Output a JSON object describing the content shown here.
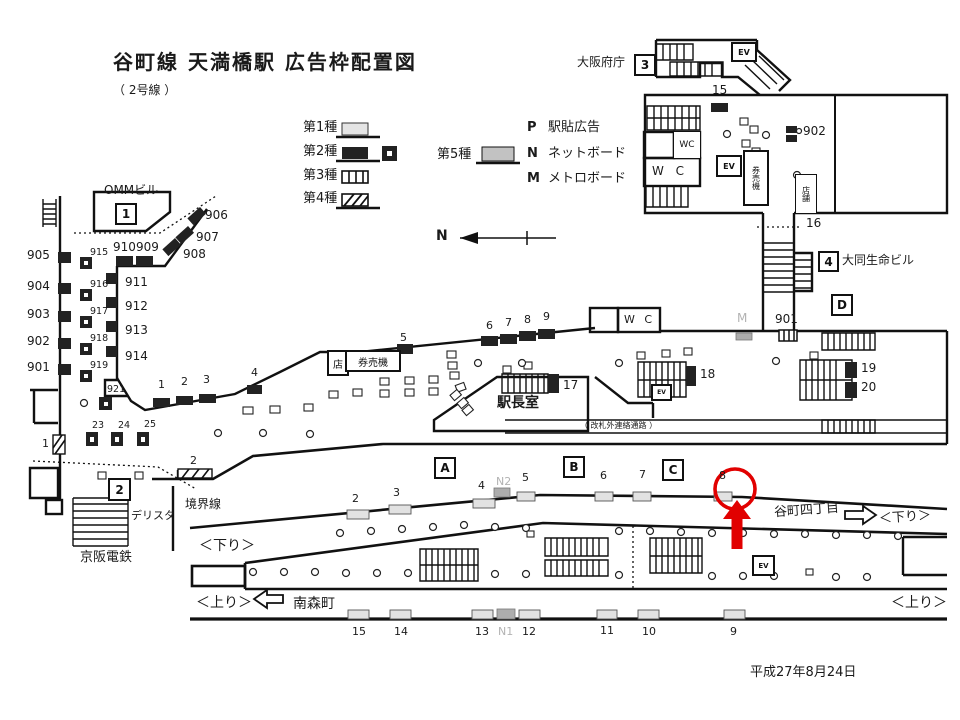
{
  "title": {
    "main": "谷町線  天満橋駅  広告枠配置図",
    "sub": "（ 2号線 ）"
  },
  "date_label": "平成27年8月24日",
  "compass": {
    "n": "N"
  },
  "legend": {
    "type1": "第1種",
    "type2": "第2種",
    "type3": "第3種",
    "type4": "第4種",
    "type5": "第5種",
    "p_code": "P",
    "p_name": "駅貼広告",
    "n_code": "N",
    "n_name": "ネットボード",
    "m_code": "M",
    "m_name": "メトロボード"
  },
  "buildings": {
    "omm": "OMMビル",
    "omm_no": "1",
    "pref": "大阪府庁",
    "pref_no": "3",
    "daido": "大同生命ビル",
    "daido_no": "4",
    "keihan": "京阪電鉄",
    "delista": "デリスタ",
    "exit_no": "2"
  },
  "facilities": {
    "wc": "WC",
    "wc_wide": "W C",
    "ev": "EV",
    "shop": "店",
    "shop_v": "店舗",
    "ticket": "券売機",
    "master": "駅長室",
    "corridor": "（ 改札外連絡通路 ）",
    "boundary": "境界線"
  },
  "nav": {
    "down": "＜下り＞",
    "up": "＜上り＞",
    "tanimachi4": "谷町四丁目",
    "minamimori": "南森町"
  },
  "zones": {
    "a": "A",
    "b": "B",
    "c": "C",
    "d": "D"
  },
  "frames": {
    "f1": "1",
    "f2": "2",
    "f3": "3",
    "f4": "4",
    "f5": "5",
    "f6": "6",
    "f7": "7",
    "f8": "8",
    "f9": "9",
    "f10": "10",
    "f11": "11",
    "f12": "12",
    "f13": "13",
    "f14": "14",
    "f15": "15",
    "f16": "16",
    "f17": "17",
    "f18": "18",
    "f19": "19",
    "f20": "20",
    "f23": "23",
    "f24": "24",
    "f25": "25",
    "f901": "901",
    "f902": "902",
    "f903": "903",
    "f904": "904",
    "f905": "905",
    "f906": "906",
    "f907": "907",
    "f908": "908",
    "f909": "909",
    "f910": "910",
    "f911": "911",
    "f912": "912",
    "f913": "913",
    "f914": "914",
    "f915": "915",
    "f916": "916",
    "f917": "917",
    "f918": "918",
    "f919": "919",
    "f921": "921",
    "fn1": "N1",
    "fn2": "N2",
    "m": "M"
  }
}
